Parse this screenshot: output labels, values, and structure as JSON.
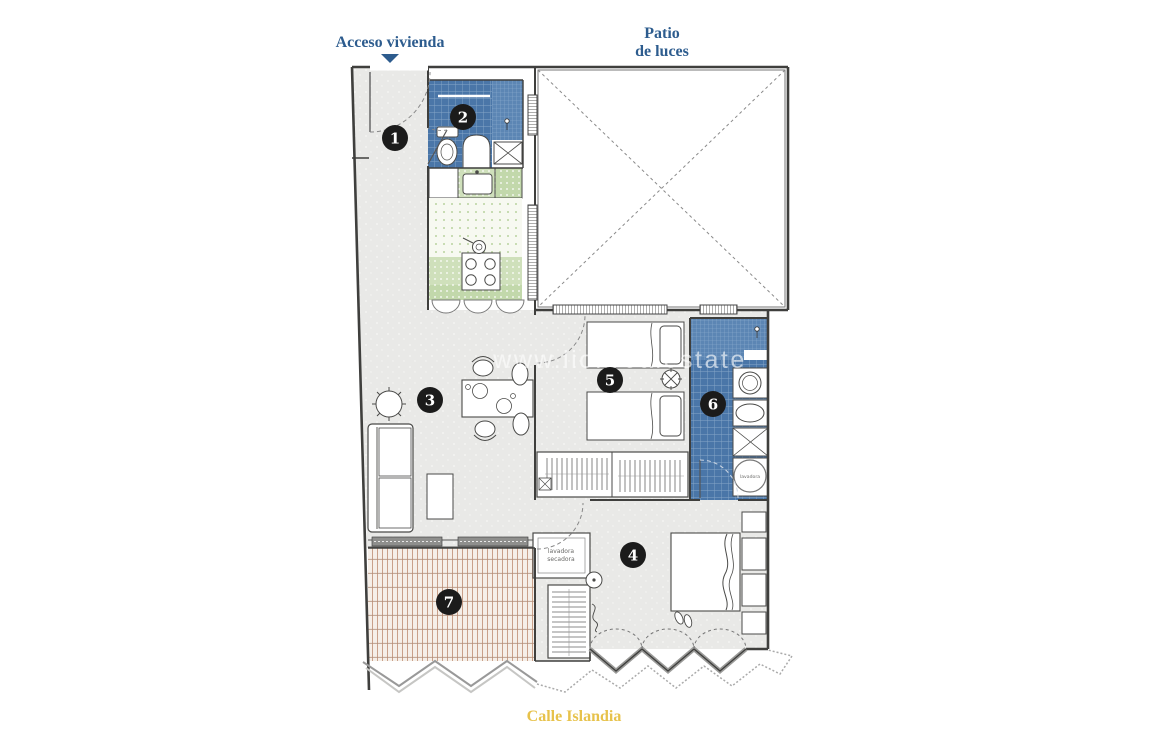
{
  "labels": {
    "access": "Acceso vivienda",
    "patio_line1": "Patio",
    "patio_line2": "de luces",
    "street": "Calle Islandia"
  },
  "watermark": "www.lionrealestate",
  "rooms": [
    {
      "label": "1"
    },
    {
      "label": "2"
    },
    {
      "label": "3"
    },
    {
      "label": "4"
    },
    {
      "label": "5"
    },
    {
      "label": "6"
    },
    {
      "label": "7"
    }
  ],
  "laundry": {
    "line1": "lavadora",
    "line2": "secadora",
    "washer": "lavadora"
  },
  "colors": {
    "label_blue": "#2d5c8e",
    "street_yellow": "#e7c24b",
    "tile_blue": "#4a76a8",
    "tile_blue_light": "#5c86b4",
    "kitchen_green": "#cfe0bb",
    "terrace_tan": "#c9a089",
    "floor_gray": "#e9e9e7",
    "wall": "#3f3f3d",
    "badge": "#1b1b1b"
  }
}
